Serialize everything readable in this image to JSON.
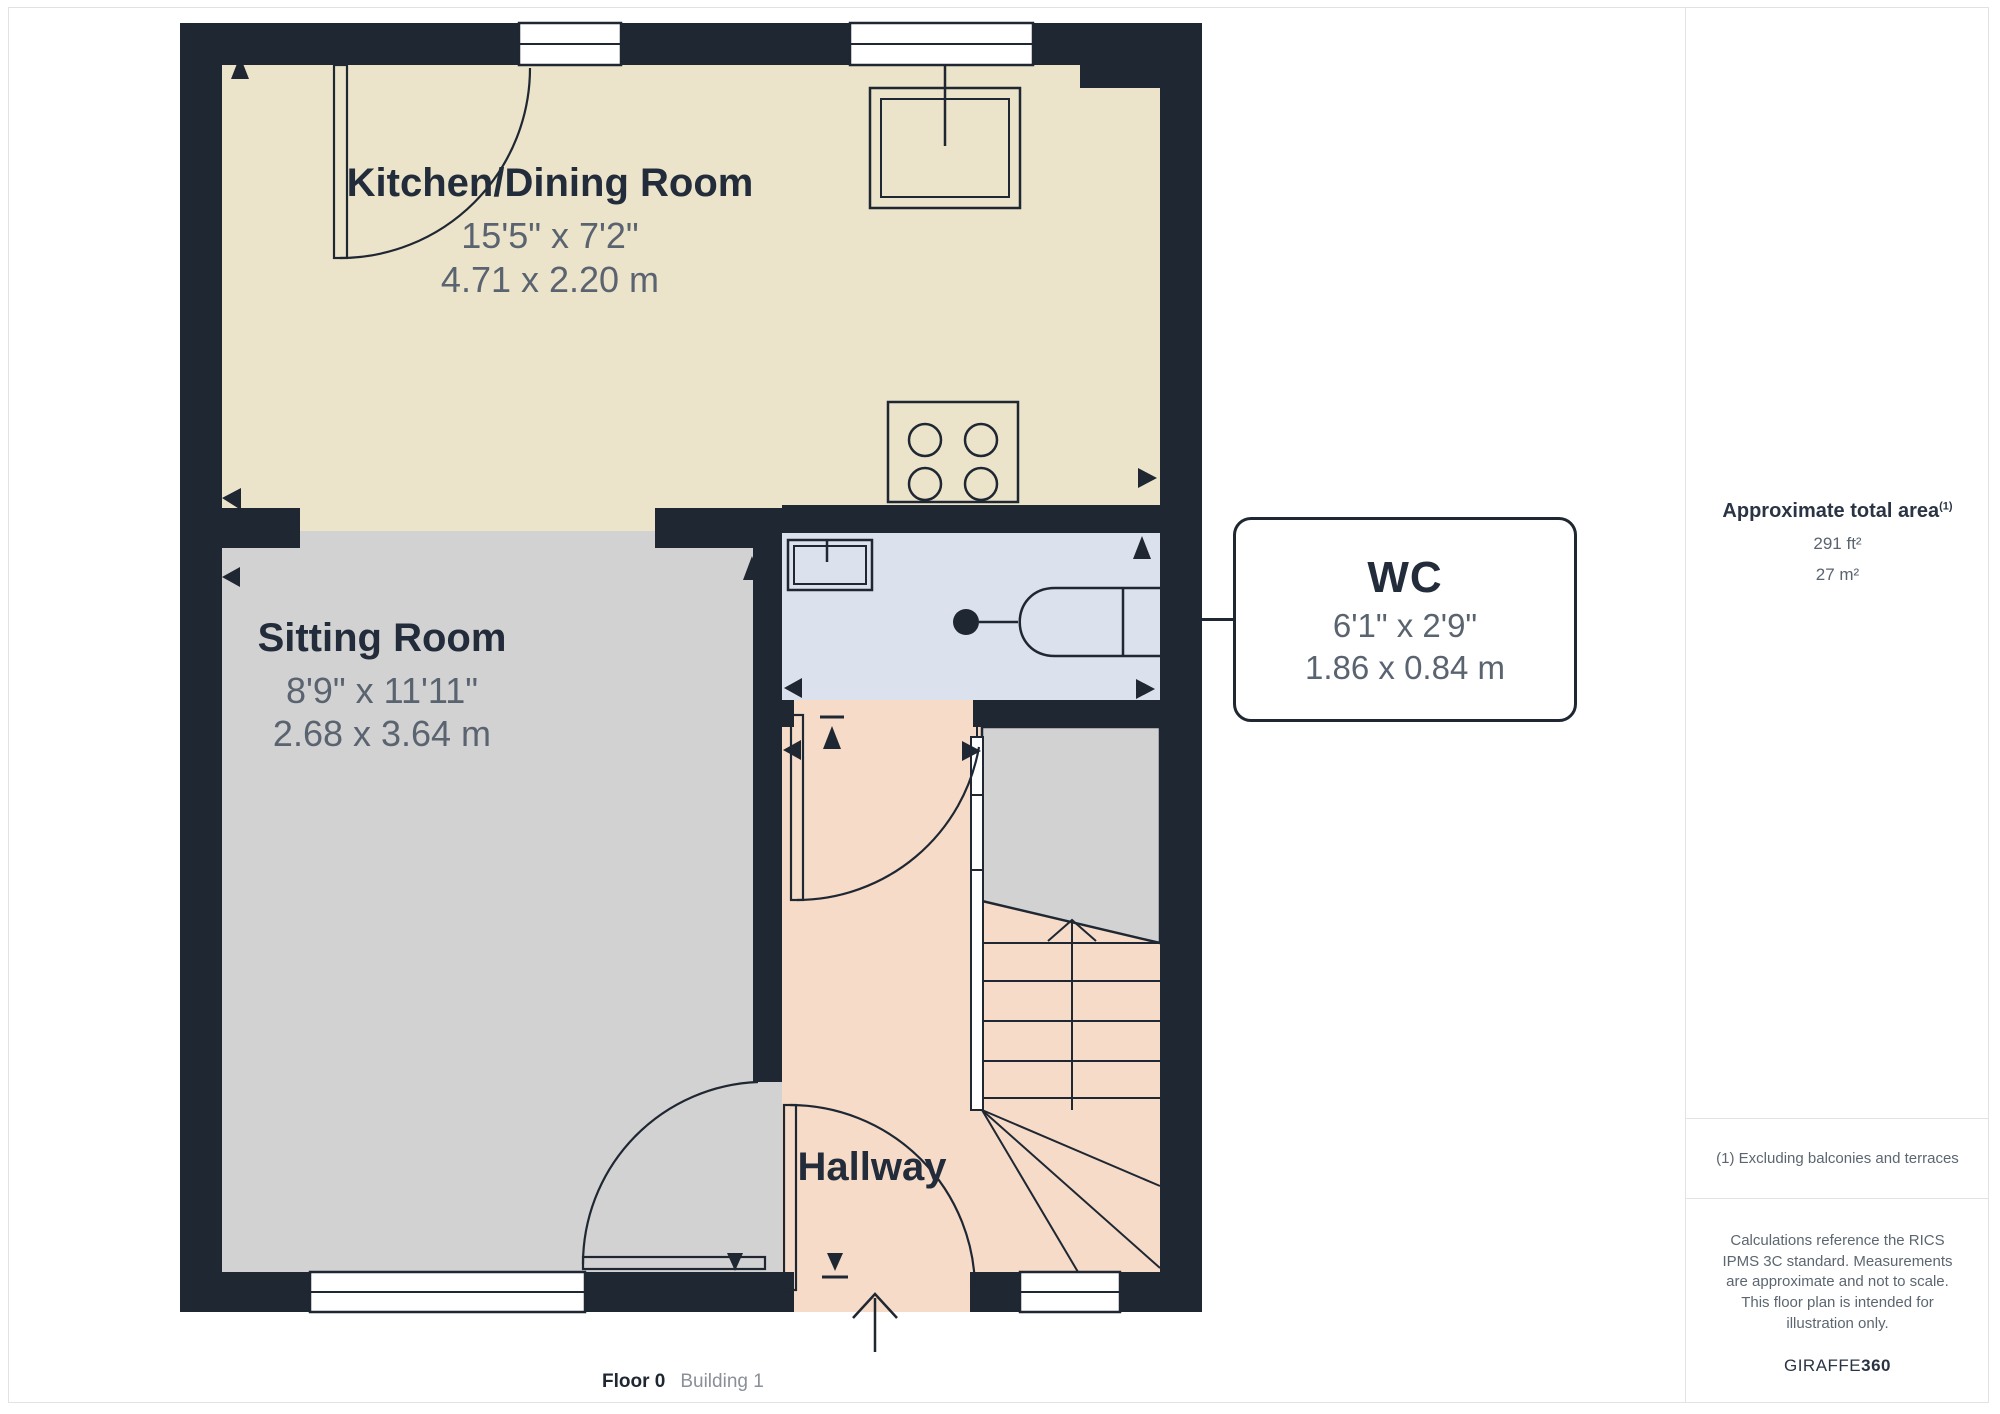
{
  "plan": {
    "rooms": [
      {
        "id": "kitchen-dining",
        "name": "Kitchen/Dining Room",
        "dims_imperial": "15'5\" x 7'2\"",
        "dims_metric": "4.71 x 2.20 m"
      },
      {
        "id": "sitting-room",
        "name": "Sitting Room",
        "dims_imperial": "8'9\" x 11'11\"",
        "dims_metric": "2.68 x 3.64 m"
      },
      {
        "id": "hallway",
        "name": "Hallway"
      },
      {
        "id": "wc",
        "name": "WC",
        "dims_imperial": "6'1\" x 2'9\"",
        "dims_metric": "1.86 x 0.84 m"
      }
    ],
    "floor_label": "Floor 0",
    "building_label": "Building 1"
  },
  "sidebar": {
    "total_area_title": "Approximate total area",
    "total_area_sup": "(1)",
    "area_ft": "291 ft²",
    "area_m": "27 m²",
    "footnote": "(1) Excluding balconies and terraces",
    "disclaimer": "Calculations reference the RICS IPMS 3C standard. Measurements are approximate and not to scale. This floor plan is intended for illustration only.",
    "brand_regular": "GIRAFFE",
    "brand_bold": "360"
  },
  "colors": {
    "wall": "#1f2733",
    "kitchen": "#ece4ca",
    "sitting": "#d2d2d2",
    "wc": "#dbe1ed",
    "hallway": "#f6dcc8",
    "label": "#232c3a",
    "dim": "#5a6370",
    "muted": "#5c6670",
    "border": "#e2e2e2",
    "brand": "#2a3444"
  }
}
